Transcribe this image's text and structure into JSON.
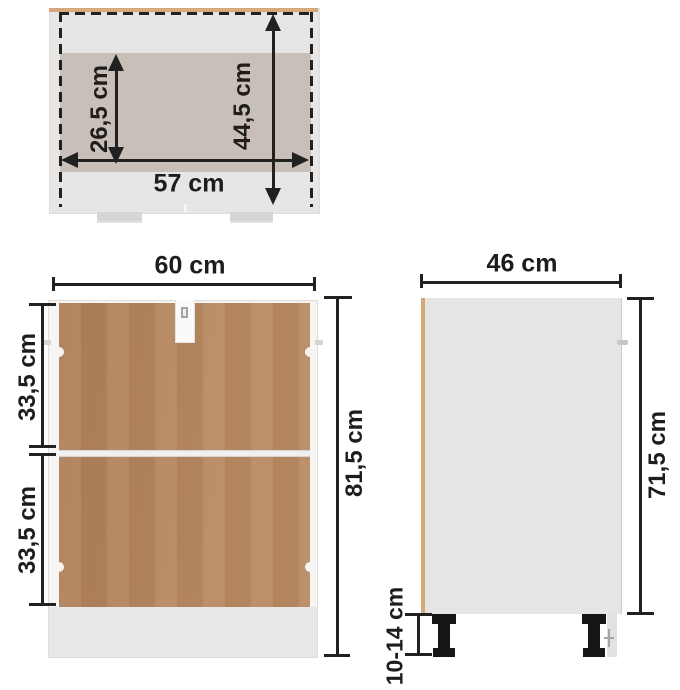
{
  "diagram": {
    "top_view": {
      "inner_depth": "26,5 cm",
      "overall_depth": "44,5 cm",
      "inner_width": "57 cm"
    },
    "back_view": {
      "width": "60 cm",
      "upper_panel_height": "33,5 cm",
      "lower_panel_height": "33,5 cm",
      "overall_height": "81,5 cm"
    },
    "side_view": {
      "depth": "46 cm",
      "body_height": "71,5 cm",
      "leg_height": "10-14 cm"
    }
  },
  "colors": {
    "background": "#ffffff",
    "dimension_ink": "#212120",
    "cabinet_white": "#f6f5f3",
    "top_body_gray": "#e8e6e4",
    "interior_band": "#c9bfb9",
    "edge_tan": "#d6a77a",
    "panel_brown": "#b5855c",
    "leg_black": "#161616",
    "plinth_strip": "#e9e8e6"
  }
}
